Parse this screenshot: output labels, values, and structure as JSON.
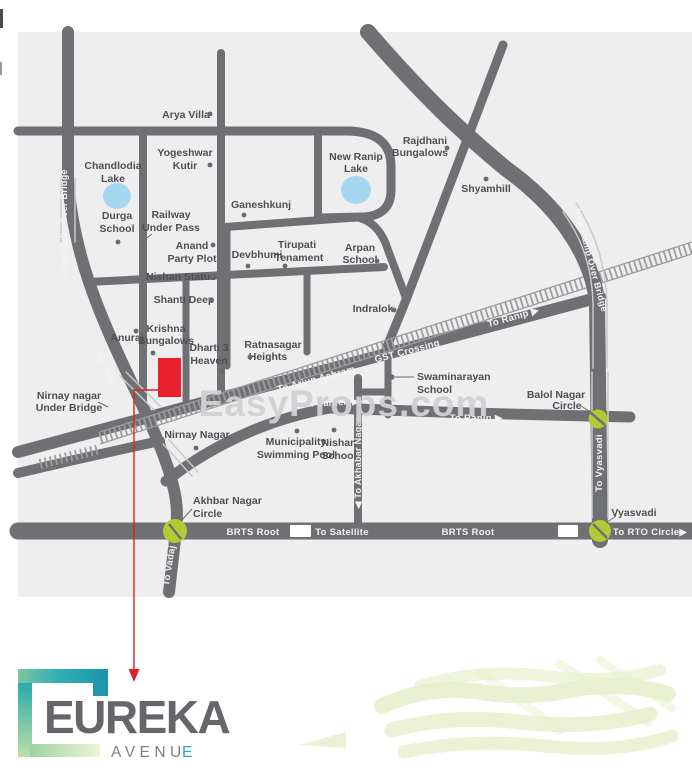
{
  "watermark": "EasyProps.com",
  "map": {
    "colors": {
      "background": "#eeeeef",
      "road": "#6f7073",
      "lake": "#a6d7f0",
      "junction_circle": "#b2cb35",
      "site_marker": "#e8212c"
    },
    "landmarks": {
      "arya_villa": {
        "label": "Arya Villa"
      },
      "yogeshwar_kutir": {
        "line1": "Yogeshwar",
        "line2": "Kutir"
      },
      "chandlodia_lake": {
        "line1": "Chandlodia",
        "line2": "Lake"
      },
      "durga_school": {
        "line1": "Durga",
        "line2": "School"
      },
      "railway_under_pass": {
        "line1": "Railway",
        "line2": "Under Pass"
      },
      "ganeshkunj": {
        "label": "Ganeshkunj"
      },
      "anand_party_plot": {
        "line1": "Anand",
        "line2": "Party Plot"
      },
      "devbhumi": {
        "label": "Devbhumi"
      },
      "tirupati_tenament": {
        "line1": "Tirupati",
        "line2": "Tenament"
      },
      "nishan_status": {
        "label": "Nishan Status"
      },
      "shanti_deep": {
        "label": "Shanti Deep"
      },
      "anuraj": {
        "label": "Anuraj"
      },
      "krishna_bungalows": {
        "line1": "Krishna",
        "line2": "Bungalows"
      },
      "dharti_3_heaven": {
        "line1": "Dharti 3",
        "line2": "Heaven"
      },
      "ratnasagar_heights": {
        "line1": "Ratnasagar",
        "line2": "Heights"
      },
      "indralok": {
        "label": "Indralok"
      },
      "arpan_school": {
        "line1": "Arpan",
        "line2": "School"
      },
      "rajdhani_bungalows": {
        "line1": "Rajdhani",
        "line2": "Bungalows"
      },
      "shyamhill": {
        "label": "Shyamhill"
      },
      "new_ranip_lake": {
        "line1": "New Ranip",
        "line2": "Lake"
      },
      "nirnay_nagar_under_bridge": {
        "line1": "Nirnay nagar",
        "line2": "Under Bridge"
      },
      "nirnay_nagar": {
        "label": "Nirnay Nagar"
      },
      "municipality_swimming_pool": {
        "line1": "Municipality",
        "line2": "Swimming Pool"
      },
      "nishan_school": {
        "line1": "Nishan",
        "line2": "School"
      },
      "swaminarayan_school": {
        "line1": "Swaminarayan",
        "line2": "School"
      },
      "akhbar_nagar_circle": {
        "line1": "Akhbar Nagar",
        "line2": "Circle"
      },
      "balol_nagar_circle": {
        "line1": "Balol Nagar",
        "line2": "Circle"
      },
      "vyasvadi": {
        "label": "Vyasvadi"
      }
    },
    "road_labels": {
      "chandlodia_over_bridge": "Chandlodia Over Bridge",
      "to_gota": "To Gota",
      "to_vadaj": "To Vadaj",
      "to_akhabar_nagar": "◀ To Akhabar Nagar",
      "to_vyasvadi": "To Vyasvadi",
      "new_ranip_over_bridge": "New Ranip Over Bridge",
      "to_arjun_ashram": "To Arjun Ashram",
      "gst_crossing": "GST Crossing",
      "to_ranip_upper": "To Ranip ▶",
      "auda_garden": "AUDA Garden ▶",
      "to_ranip_lower": "To Ranip ▶",
      "brts_root_west": "BRTS Root",
      "to_satellite": "To Satellite",
      "brts_root_east": "BRTS Root",
      "to_rto_circle": "To RTO Circle▶"
    }
  },
  "logo": {
    "title": "EUREKA",
    "subtitle_main": "AVENU",
    "subtitle_accent": "E"
  }
}
